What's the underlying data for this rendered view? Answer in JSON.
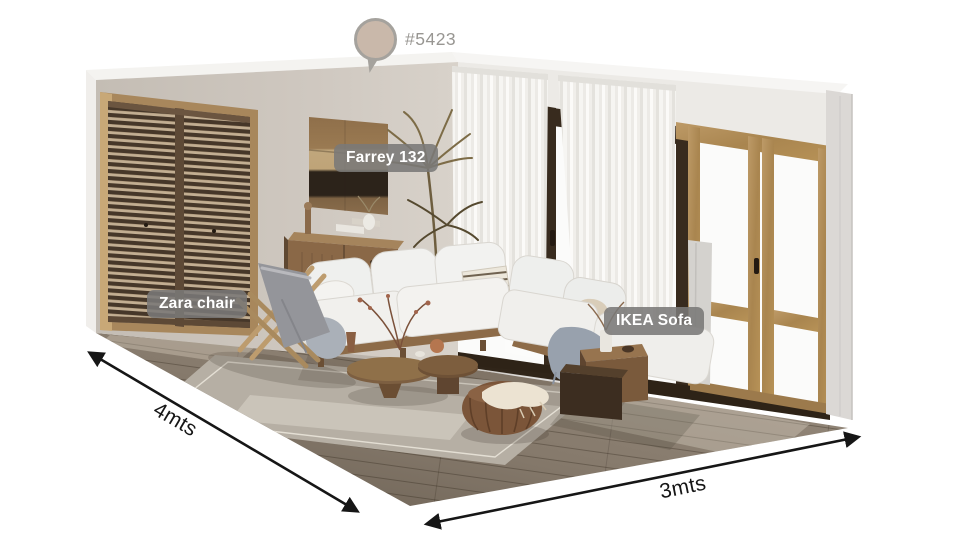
{
  "swatch": {
    "code": "#5423",
    "color": "#c9b8aa"
  },
  "annotations": {
    "tags": [
      {
        "id": "artwork",
        "label": "Farrey 132"
      },
      {
        "id": "chair",
        "label": "Zara chair"
      },
      {
        "id": "sofa",
        "label": "IKEA Sofa"
      }
    ]
  },
  "dimensions": {
    "left_wall": "4mts",
    "right_wall": "3mts"
  }
}
